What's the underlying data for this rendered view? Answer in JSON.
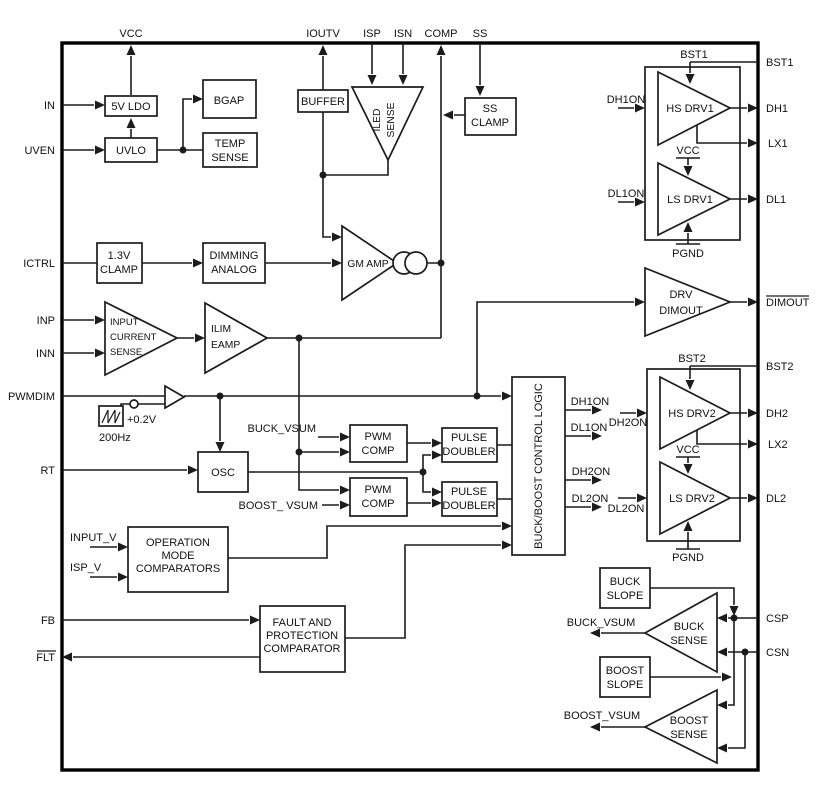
{
  "colors": {
    "line": "#1c1c1c",
    "background": "#ffffff"
  },
  "pins": {
    "vcc": "VCC",
    "ioutv": "IOUTV",
    "isp": "ISP",
    "isn": "ISN",
    "comp": "COMP",
    "ss": "SS",
    "in": "IN",
    "uven": "UVEN",
    "ictrl": "ICTRL",
    "inp": "INP",
    "inn": "INN",
    "pwmdim": "PWMDIM",
    "rt": "RT",
    "fb": "FB",
    "flt": "FLT",
    "bst1": "BST1",
    "dh1": "DH1",
    "lx1": "LX1",
    "dl1": "DL1",
    "dimout": "DIMOUT",
    "bst2": "BST2",
    "dh2": "DH2",
    "lx2": "LX2",
    "dl2": "DL2",
    "csp": "CSP",
    "csn": "CSN"
  },
  "blocks": {
    "ldo": "5V LDO",
    "uvlo": "UVLO",
    "bgap": "BGAP",
    "temp_sense": [
      "TEMP",
      "SENSE"
    ],
    "buffer": "BUFFER",
    "iled_sense": [
      "ILED",
      "SENSE"
    ],
    "ss_clamp": [
      "SS",
      "CLAMP"
    ],
    "clamp13": [
      "1.3V",
      "CLAMP"
    ],
    "dimming": [
      "DIMMING",
      "ANALOG"
    ],
    "gm_amp": "GM AMP",
    "input_sense": [
      "INPUT",
      "CURRENT",
      "SENSE"
    ],
    "ilim_eamp": [
      "ILIM",
      "EAMP"
    ],
    "osc": "OSC",
    "pwm_comp": [
      "PWM",
      "COMP"
    ],
    "pulse_doubler": [
      "PULSE",
      "DOUBLER"
    ],
    "control_logic": "BUCK/BOOST CONTROL LOGIC",
    "op_mode": [
      "OPERATION",
      "MODE",
      "COMPARATORS"
    ],
    "fault": [
      "FAULT AND",
      "PROTECTION",
      "COMPARATOR"
    ],
    "drv_dimout": [
      "DRV",
      "DIMOUT"
    ],
    "hs_drv1": "HS DRV1",
    "ls_drv1": "LS DRV1",
    "hs_drv2": "HS DRV2",
    "ls_drv2": "LS DRV2",
    "buck_slope": [
      "BUCK",
      "SLOPE"
    ],
    "buck_sense": [
      "BUCK",
      "SENSE"
    ],
    "boost_slope": [
      "BOOST",
      "SLOPE"
    ],
    "boost_sense": [
      "BOOST",
      "SENSE"
    ]
  },
  "signals": {
    "bst1": "BST1",
    "bst2": "BST2",
    "vcc1": "VCC",
    "vcc2": "VCC",
    "pgnd1": "PGND",
    "pgnd2": "PGND",
    "dh1on": "DH1ON",
    "dl1on": "DL1ON",
    "dh2on": "DH2ON",
    "dl2on": "DL2ON",
    "buck_vsum_in": "BUCK_VSUM",
    "boost_vsum_in": "BOOST_ VSUM",
    "buck_vsum_out": "BUCK_VSUM",
    "boost_vsum_out": "BOOST_VSUM",
    "input_v": "INPUT_V",
    "isp_v": "ISP_V",
    "offset": "+0.2V",
    "freq": "200Hz"
  }
}
